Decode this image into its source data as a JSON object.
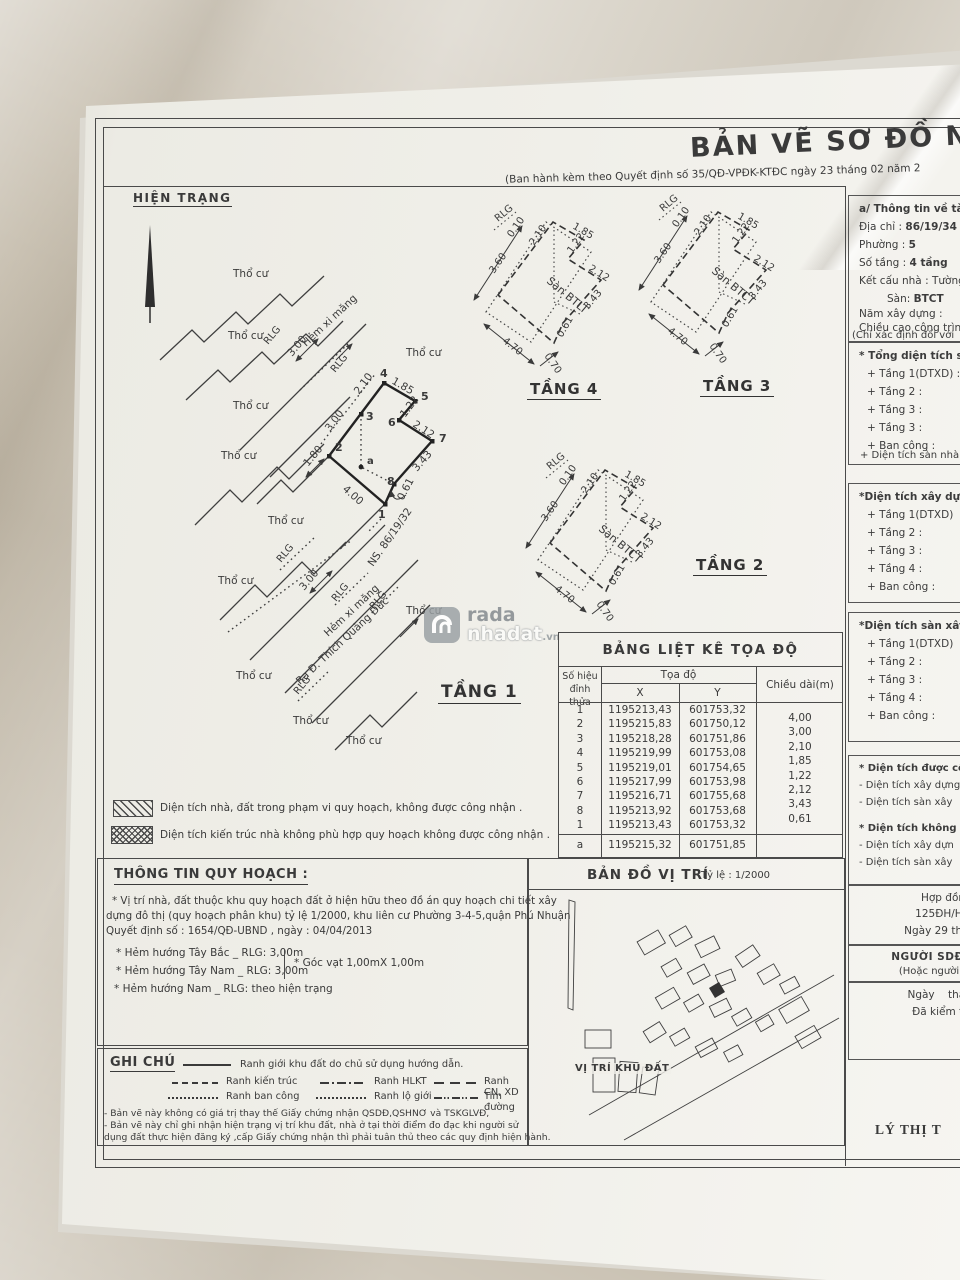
{
  "header": {
    "title": "BẢN VẼ SƠ ĐỒ NH",
    "subtitle": "(Ban hành kèm theo Quyết định số 35/QĐ-VPĐK-KTĐC ngày 23 tháng 02 năm 2",
    "status_label": "HIỆN TRẠNG"
  },
  "site_plan": {
    "tho_cu": "Thổ cư",
    "rlg": "RLG",
    "hem_xi_mang": "Hẻm xi măng",
    "ns_label": "NS. 86/19/32",
    "street_label": "Ra Đ. Thích Quảng Đức",
    "dim_300": "3.00",
    "dim_180": "1.80",
    "edges": {
      "e12": "4.00",
      "e23": "3.00",
      "e34": "2.10",
      "e45": "1.85",
      "e56": "1.22",
      "e67": "2.12",
      "e78": "3.43",
      "e81": "0.61"
    },
    "vertices": [
      "1",
      "2",
      "3",
      "4",
      "5",
      "6",
      "7",
      "8"
    ],
    "point_a": "a"
  },
  "floor_plans": {
    "tang1": "TẦNG 1",
    "tang2": "TẦNG 2",
    "tang3": "TẦNG 3",
    "tang4": "TẦNG 4",
    "san_btlt": "Sàn BTLT",
    "san_btct": "Sàn BTCT",
    "rlg": "RLG",
    "dims": {
      "d470": "4.70",
      "d360": "3.60",
      "d010": "0.10",
      "d070": "0.70",
      "d185": "1.85",
      "d210": "2.10",
      "d122": "1.22",
      "d212": "2.12",
      "d343": "3.43",
      "d061": "0.61"
    }
  },
  "watermark": {
    "line1": "rada",
    "line2": "nhadat",
    "suffix": ".vn"
  },
  "coord_table": {
    "title": "BẢNG LIỆT KÊ TỌA ĐỘ",
    "col_id_1": "Số hiệu",
    "col_id_2": "đỉnh thửa",
    "col_toado": "Tọa độ",
    "col_x": "X",
    "col_y": "Y",
    "col_len": "Chiều dài(m)",
    "rows": [
      {
        "id": "1",
        "x": "1195213,43",
        "y": "601753,32"
      },
      {
        "id": "2",
        "x": "1195215,83",
        "y": "601750,12"
      },
      {
        "id": "3",
        "x": "1195218,28",
        "y": "601751,86"
      },
      {
        "id": "4",
        "x": "1195219,99",
        "y": "601753,08"
      },
      {
        "id": "5",
        "x": "1195219,01",
        "y": "601754,65"
      },
      {
        "id": "6",
        "x": "1195217,99",
        "y": "601753,98"
      },
      {
        "id": "7",
        "x": "1195216,71",
        "y": "601755,68"
      },
      {
        "id": "8",
        "x": "1195213,92",
        "y": "601753,68"
      },
      {
        "id": "1",
        "x": "1195213,43",
        "y": "601753,32"
      }
    ],
    "lengths": [
      "4,00",
      "3,00",
      "2,10",
      "1,85",
      "1,22",
      "2,12",
      "3,43",
      "0,61"
    ],
    "footer": {
      "id": "a",
      "x": "1195215,32",
      "y": "601751,85"
    }
  },
  "hatch_legend": {
    "item1": "Diện tích nhà, đất trong phạm vi quy hoạch, không được công nhận .",
    "item2": "Diện tích kiến trúc nhà không phù hợp quy hoạch không được công nhận ."
  },
  "quy_hoach": {
    "title": "THÔNG TIN QUY HOẠCH :",
    "para1": "* Vị trí nhà, đất thuộc khu quy hoạch đất ở hiện hữu theo đồ án quy hoạch chi tiết xây",
    "para2": "dựng đô thị (quy hoạch phân khu) tỷ lệ 1/2000, khu liên cư Phường 3-4-5,quận Phú Nhuận",
    "para3": "Quyết định số : 1654/QĐ-UBND , ngày : 04/04/2013",
    "bullet1": "* Hẻm hướng Tây Bắc _ RLG: 3,00m",
    "bullet2": "* Hẻm hướng Tây Nam _ RLG: 3,00m",
    "bullet3": "* Hẻm hướng  Nam _ RLG: theo hiện trạng",
    "bullet_side": "* Góc vạt 1,00mX 1,00m"
  },
  "ghi_chu": {
    "title": "GHI CHÚ",
    "l1": "Ranh giới khu đất do chủ sử dụng hướng dẫn.",
    "l2": "Ranh kiến trúc",
    "l3": "Ranh HLKT",
    "l4": "Ranh CN, XD",
    "l5": "Ranh ban công",
    "l6": "Ranh lộ giới",
    "l7": "Tim đường",
    "note1": "- Bản vẽ này không có giá trị thay thế Giấy chứng nhận QSDĐ,QSHNƠ và TSKGLVĐ,",
    "note2": "- Bản vẽ này chỉ ghi nhận hiện trạng vị trí khu đất, nhà ở tại thời điểm đo đạc khi người sử",
    "note3": "dụng đất thực hiện đăng ký ,cấp Giấy chứng nhận thì phải tuân thủ theo các quy định hiện hành."
  },
  "location_map": {
    "title": "BẢN ĐỒ VỊ TRÍ",
    "scale": "Tỷ lệ : 1/2000",
    "site_label": "VỊ TRÍ KHU ĐẤT"
  },
  "info_panel": {
    "section_a_title": "a/ Thông tin về tài sản",
    "f1_label": "Địa chỉ :",
    "f1_value": "86/19/34",
    "f2_label": "Phường :",
    "f2_value": "5",
    "f3_label": "Số tầng :",
    "f3_value": "4 tầng",
    "f4_label": "Kết cấu nhà :",
    "f4_value": "Tường",
    "f5_label": "Sàn:",
    "f5_value": "BTCT",
    "f6_label": "Năm xây dựng :",
    "f7_label": "Chiều cao công trình",
    "note": "(Chỉ xác định đối với",
    "s1_title": "* Tổng diện tích sàn",
    "s1_items": [
      "+ Tầng 1(DTXD) :",
      "+ Tầng 2 :",
      "+ Tầng 3 :",
      "+ Tầng 3 :",
      "+ Ban công :"
    ],
    "s1_footer": "+ Diện tích sàn nhà",
    "s2_title": "*Diện tích xây dựng",
    "s2_items": [
      "+ Tầng 1(DTXD)",
      "+ Tầng 2 :",
      "+ Tầng 3 :",
      "+ Tầng 4 :",
      "+ Ban công :"
    ],
    "s3_title": "*Diện tích sàn xây",
    "s3_items": [
      "+ Tầng 1(DTXD)",
      "+ Tầng 2 :",
      "+ Tầng 3 :",
      "+ Tầng 4 :",
      "+ Ban công :"
    ],
    "s4_title": "* Diện tích được công",
    "s4_items": [
      "- Diện tích xây dựng",
      "- Diện tích sàn xây"
    ],
    "s5_title": "* Diện tích không đ",
    "s5_items": [
      "- Diện tích xây dựn",
      "- Diện tích sàn xây"
    ],
    "contract1": "Hợp đồn",
    "contract2": "125ĐH/HĐ",
    "contract3": "Ngày 29 tháng",
    "sdd1": "NGƯỜI SDĐ,CHỦ",
    "sdd2": "(Hoặc người đại d",
    "check1": "Ngày    tháng",
    "check2": "Đã kiểm tra",
    "signature": "LÝ THỊ T"
  }
}
